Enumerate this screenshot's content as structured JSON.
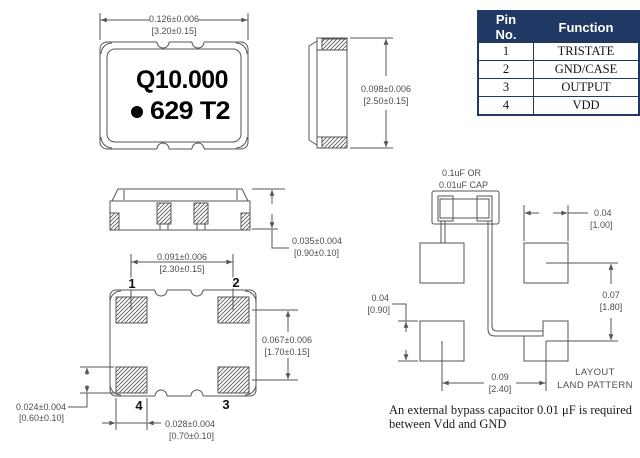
{
  "part": {
    "marking_line1": "Q10.000",
    "marking_line2": "629 T2"
  },
  "pin_table": {
    "headers": [
      "Pin No.",
      "Function"
    ],
    "rows": [
      [
        "1",
        "TRISTATE"
      ],
      [
        "2",
        "GND/CASE"
      ],
      [
        "3",
        "OUTPUT"
      ],
      [
        "4",
        "VDD"
      ]
    ]
  },
  "pad_numbers": {
    "p1": "1",
    "p2": "2",
    "p3": "3",
    "p4": "4"
  },
  "dimensions": {
    "body_width": {
      "in": "0.126±0.006",
      "mm": "[3.20±0.15]"
    },
    "body_length": {
      "in": "0.098±0.006",
      "mm": "[2.50±0.15]"
    },
    "body_height": {
      "in": "0.035±0.004",
      "mm": "[0.90±0.10]"
    },
    "pad_span_x": {
      "in": "0.091±0.006",
      "mm": "[2.30±0.15]"
    },
    "pad_span_y": {
      "in": "0.067±0.006",
      "mm": "[1.70±0.15]"
    },
    "pad_height": {
      "in": "0.024±0.004",
      "mm": "[0.60±0.10]"
    },
    "pad_width": {
      "in": "0.028±0.004",
      "mm": "[0.70±0.10]"
    }
  },
  "land_pattern": {
    "cap_label_line1": "0.1uF OR",
    "cap_label_line2": "0.01uF CAP",
    "pad_width": {
      "in": "0.04",
      "mm": "[1.00]"
    },
    "pitch_y": {
      "in": "0.07",
      "mm": "[1.80]"
    },
    "pad_height": {
      "in": "0.04",
      "mm": "[0.90]"
    },
    "pitch_x": {
      "in": "0.09",
      "mm": "[2.40]"
    },
    "label_line1": "LAYOUT",
    "label_line2": "LAND PATTERN"
  },
  "note_text": "An external bypass capacitor 0.01 μF is required between Vdd and GND",
  "colors": {
    "table_header_bg": "#1f3864",
    "table_border": "#1f3864",
    "drawing_line": "#555555",
    "dimension_text": "#4d4d4d"
  }
}
